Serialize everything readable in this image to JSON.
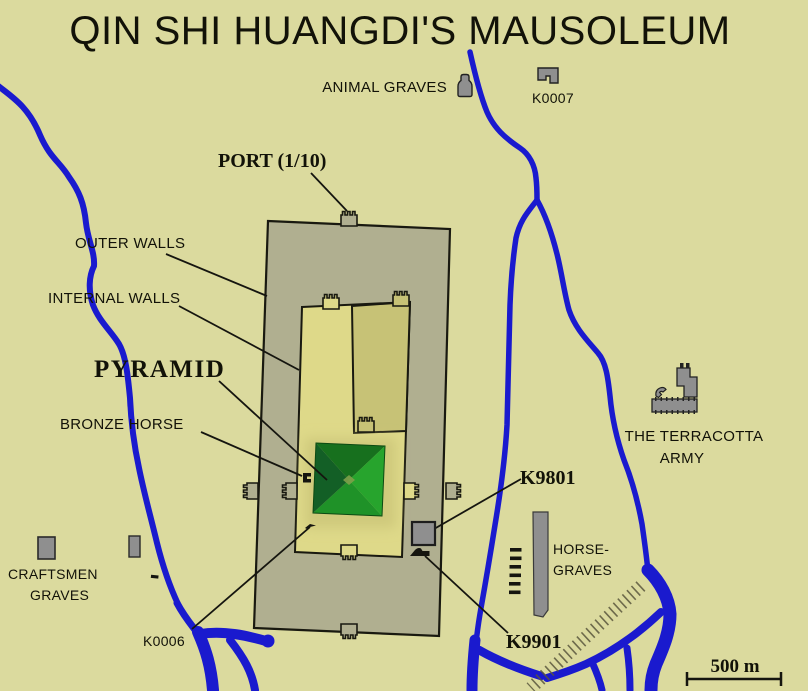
{
  "title": "QIN SHI HUANGDI'S MAUSOLEUM",
  "labels": {
    "animal_graves": "ANIMAL GRAVES",
    "k0007": "K0007",
    "port": "PORT (1/10)",
    "outer_walls": "OUTER WALLS",
    "internal_walls": "INTERNAL WALLS",
    "pyramid": "PYRAMID",
    "bronze_horse": "BRONZE HORSE",
    "terracotta_line1": "THE TERRACOTTA",
    "terracotta_line2": "ARMY",
    "k9801": "K9801",
    "horse_graves_line1": "HORSE-",
    "horse_graves_line2": "GRAVES",
    "craftsmen_line1": "CRAFTSMEN",
    "craftsmen_line2": "GRAVES",
    "k0006": "K0006",
    "k9901": "K9901",
    "scale": "500 m"
  },
  "icons": [
    "animal-graves-pit-icon",
    "k0007-pit-icon",
    "terracotta-pits-icon",
    "craftsmen-grave-pit-icon",
    "k9801-pit-icon",
    "k9901-pit-icon",
    "bronze-horse-pit-icon",
    "k0006-pit-icon",
    "horse-graves-bar-icon",
    "small-grave-dashes-icon"
  ],
  "colors": {
    "background": "#dbda9e",
    "outer_ward": "#b0af90",
    "inner_court": "#ded989",
    "ne_court": "#c7c276",
    "apron": "#cfc97c",
    "pyramid_north": "#17701e",
    "pyramid_east": "#27a42d",
    "pyramid_south": "#1f9228",
    "pyramid_west": "#135f26",
    "pyramid_center": "#7fa04a",
    "river": "#1a1ace",
    "wall_line": "#191910",
    "icon_gray": "#8f8f8f",
    "text": "#121208"
  }
}
